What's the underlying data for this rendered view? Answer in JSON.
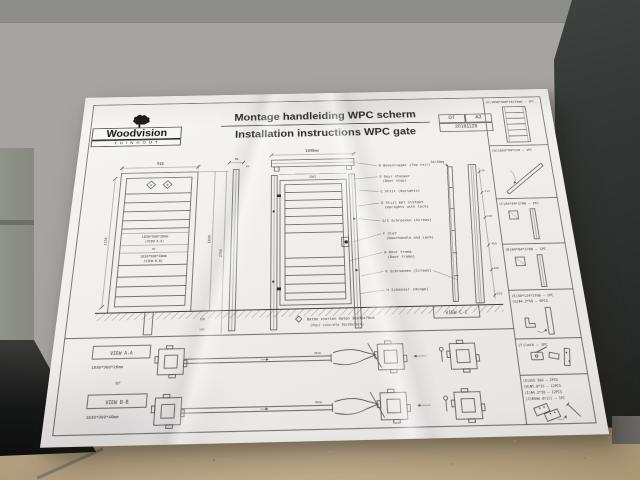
{
  "scene": {
    "colors": {
      "wall": "#a6a3a0",
      "wall_top": "#8d8d8b",
      "dark_cabinet": "#343937",
      "green_panel": "#90938a",
      "cardboard": "#cbb592",
      "paper": "#f0efed",
      "ink": "#3b3b3b"
    }
  },
  "sheet": {
    "logo": {
      "brand": "Woodvision",
      "sub": "TUINHOUT"
    },
    "title": {
      "nl": "Montage handleiding WPC scherm",
      "en": "Installation instructions WPC gate"
    },
    "meta": {
      "code": "DT",
      "size": "A3",
      "date": "20181128"
    },
    "parts": [
      "(A)1830*900*26/40mm — 1PC",
      "(B)1090*90*120 — 1PC",
      "(C)84*84*2700 — 1PC",
      "(D)84*84*2700 — 1PC",
      "(E)50*124*2700 — 1PC",
      "(G)Φ4.2*50 — 6PCS",
      "(F)lock — 1PC",
      "(G)SUS 304 — 2PCS",
      "(H)Φ5.0*25 — 12PCS",
      "(I)Φ4.2*50 — 12PCS",
      "(J)Φ3mm drill — 1PC"
    ],
    "callouts": [
      {
        "l1": "B Bovenligger (Top rail)",
        "l2": ""
      },
      {
        "l1": "E Deur stopper",
        "l2": "(Door stop)"
      },
      {
        "l1": "C Stijl (Uprights)",
        "l2": ""
      },
      {
        "l1": "D Stijl met slotgat",
        "l2": "(Uprights with lock)"
      },
      {
        "l1": "G/I Schroeven (Screws)",
        "l2": ""
      },
      {
        "l1": "F Slot",
        "l2": "(Doorhandle and Lock)"
      },
      {
        "l1": "A Deur frame",
        "l2": "(Door frame)"
      },
      {
        "l1": "K Schroeven (Screws)",
        "l2": ""
      },
      {
        "l1": "H Schanier (Hinge)",
        "l2": ""
      }
    ],
    "gate_label": {
      "size1": "1830*900*26mm",
      "view1": "(VIEW A-A)",
      "or": "or",
      "size2": "1830*900*40mm",
      "view2": "(VIEW B-B)"
    },
    "views": {
      "aa": "VIEW A-A",
      "aa_dim": "1830*900*26mm",
      "or": "or",
      "bb": "VIEW B-B",
      "bb_dim": "1830*900*40mm",
      "cc": "VIEW C-C"
    },
    "note": {
      "nl": "Beton storten Gaten 30x30x70cm",
      "en": "(Pour concrete  30x30x70cm)"
    },
    "markers": {
      "a": "A",
      "b": "B"
    },
    "dims": {
      "gate_w": "916",
      "gate_h": "1150",
      "h1830": "1830",
      "h2700": "2700",
      "d100": "100",
      "d300": "300",
      "d90": "90",
      "d84": "84",
      "rail": "1090mm",
      "rail_inner": "1001",
      "thickness": "34/40mm",
      "d28": "28",
      "d415": "415",
      "d190": "190",
      "d460": "460",
      "d480": "480",
      "d250": "250",
      "t26": "26mm",
      "t40": "40mm"
    }
  }
}
